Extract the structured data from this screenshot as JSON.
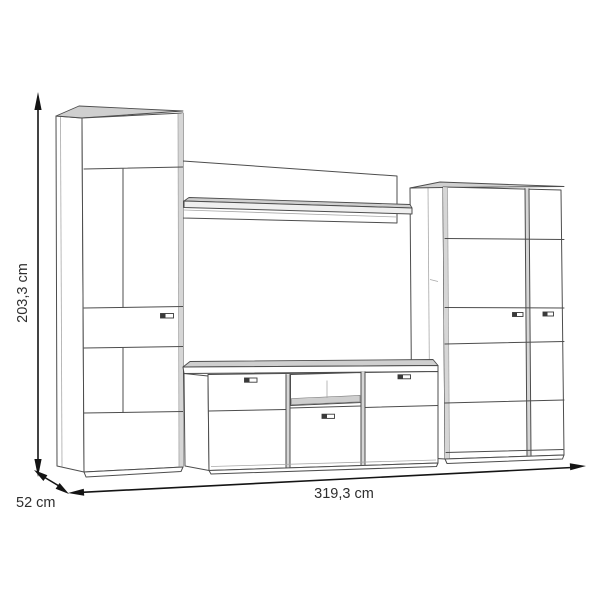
{
  "diagram": {
    "type": "furniture-dimension-drawing",
    "subject": "tv-wall-unit",
    "dimensions": {
      "height": "203,3 cm",
      "depth": "52 cm",
      "width": "319,3 cm"
    },
    "colors": {
      "background": "#ffffff",
      "furniture_outline": "#4d4d4d",
      "panel_shading": "#d6d6d6",
      "dimension_lines": "#141414",
      "label_text": "#2e2e2e"
    }
  }
}
